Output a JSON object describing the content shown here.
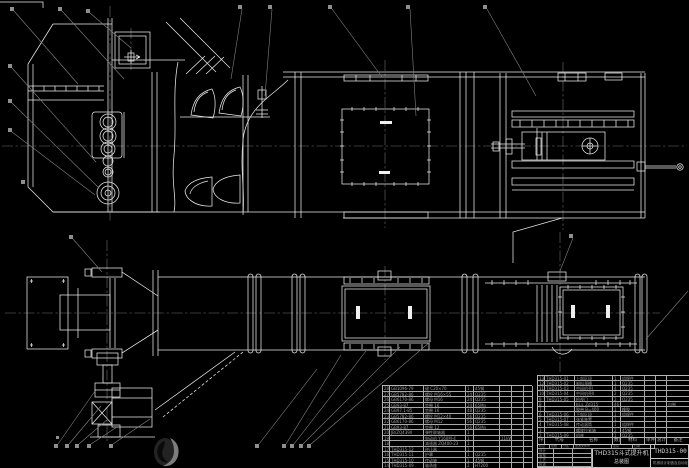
{
  "title_block": {
    "product": "THD315斗式提升机",
    "sub": "总装图",
    "drawing_no": "THD315-00",
    "org": "机械设计制造及自动化",
    "strip": [
      [
        "标记",
        "处数",
        "分区",
        "更改文件号",
        "签名",
        "日期"
      ]
    ],
    "left_rows": [
      [
        "设计",
        "",
        ""
      ],
      [
        "审核",
        "",
        ""
      ],
      [
        "工艺",
        "",
        ""
      ],
      [
        "批准",
        "",
        ""
      ]
    ]
  },
  "bom_right": {
    "header": [
      [
        "序号",
        "代号",
        "名称",
        "数量",
        "材料",
        "单件",
        "总计",
        "备注"
      ]
    ],
    "rows": [
      [
        "13",
        "THD315-01",
        "上部区段",
        "1",
        "组焊件",
        "",
        "",
        ""
      ],
      [
        "12",
        "THD315-02",
        "卸料溜槽",
        "1",
        "Q235",
        "",
        "",
        ""
      ],
      [
        "11",
        "THD315-03",
        "中间机壳Ⅰ",
        "4",
        "Q235",
        "",
        "",
        ""
      ],
      [
        "10",
        "THD315-04",
        "中间机壳Ⅱ",
        "2",
        "Q235",
        "",
        "",
        ""
      ],
      [
        "9",
        "THD315-05",
        "检视门",
        "2",
        "Q235",
        "",
        "",
        ""
      ],
      [
        "8",
        "",
        "料斗 Zd315",
        "46",
        "",
        "",
        "",
        "自制"
      ],
      [
        "7",
        "",
        "胶带 B=400",
        "1",
        "橡胶",
        "",
        "",
        ""
      ],
      [
        "6",
        "THD315-06",
        "下部区段",
        "1",
        "组焊件",
        "",
        "",
        ""
      ],
      [
        "5",
        "THD315-07",
        "张紧装置",
        "1",
        "",
        "",
        "",
        ""
      ],
      [
        "4",
        "THD315-08",
        "传动滚筒",
        "1",
        "组焊件",
        "",
        "",
        ""
      ],
      [
        "3",
        "",
        "螺旋拉紧轴",
        "2",
        "45钢",
        "",
        "",
        ""
      ],
      [
        "2",
        "THD315-09",
        "机座",
        "1",
        "Q235",
        "",
        "",
        ""
      ]
    ]
  },
  "bom_left": {
    "rows": [
      [
        "28",
        "GB1096-79",
        "键 C20×70",
        "1",
        "45钢",
        "",
        "",
        ""
      ],
      [
        "27",
        "GB5782-86",
        "螺栓 M16×55",
        "24",
        "Q235",
        "",
        "",
        ""
      ],
      [
        "26",
        "GB6170-86",
        "螺母 M16",
        "24",
        "Q235",
        "",
        "",
        ""
      ],
      [
        "25",
        "GB93-87",
        "垫圈 16",
        "24",
        "65Mn",
        "",
        "",
        ""
      ],
      [
        "24",
        "GB97.1-85",
        "垫圈 16",
        "48",
        "Q235",
        "",
        "",
        ""
      ],
      [
        "23",
        "GB5782-86",
        "螺栓 M12×40",
        "56",
        "Q235",
        "",
        "",
        ""
      ],
      [
        "22",
        "GB6170-86",
        "螺母 M12",
        "56",
        "Q235",
        "",
        "",
        ""
      ],
      [
        "21",
        "GB93-87",
        "垫圈 12",
        "56",
        "65Mn",
        "",
        "",
        ""
      ],
      [
        "20",
        "JB/ZQ4390",
        "弹性联轴器",
        "1",
        "",
        "",
        "",
        ""
      ],
      [
        "19",
        "",
        "电动机 Y160M-4",
        "1",
        "",
        "11kW",
        "",
        ""
      ],
      [
        "18",
        "",
        "减速器 ZQ400-23",
        "1",
        "",
        "",
        "",
        ""
      ],
      [
        "17",
        "THD315-12",
        "逆止器",
        "1",
        "",
        "",
        "",
        ""
      ],
      [
        "16",
        "THD315-11",
        "护罩",
        "1",
        "Q235",
        "",
        "",
        ""
      ],
      [
        "15",
        "THD315-10",
        "传动轴",
        "1",
        "45钢",
        "",
        "",
        ""
      ],
      [
        "14",
        "THD315-09",
        "轴承座",
        "2",
        "HT200",
        "",
        "",
        ""
      ]
    ]
  }
}
